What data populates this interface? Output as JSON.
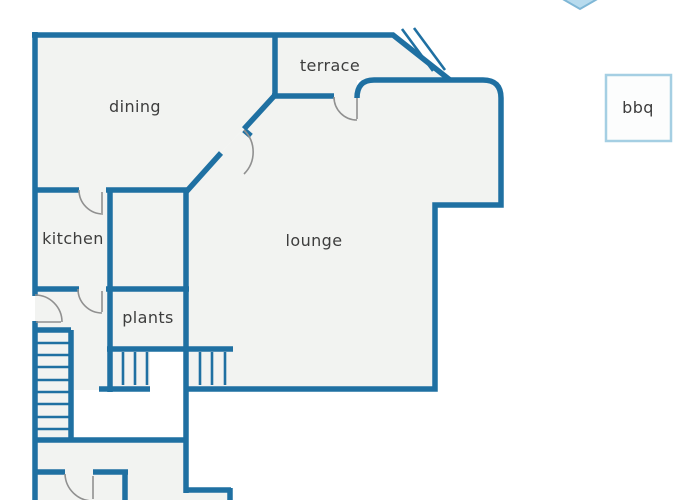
{
  "floorplan": {
    "rooms": [
      {
        "id": "dining",
        "label": "dining"
      },
      {
        "id": "terrace",
        "label": "terrace"
      },
      {
        "id": "kitchen",
        "label": "kitchen"
      },
      {
        "id": "lounge",
        "label": "lounge"
      },
      {
        "id": "plants",
        "label": "plants"
      },
      {
        "id": "bbq",
        "label": "bbq"
      }
    ],
    "features": {
      "staircase_steps": 8,
      "porch_step_flights": 2,
      "terrace_hatch_marks": 2,
      "door_arcs": 6
    },
    "colors": {
      "wall": "#1f70a2",
      "room_fill": "#f2f3f1",
      "door_arc": "#909090",
      "label_text": "#3d3d3d",
      "bbq_border": "#a5cfe3",
      "diamond_fill": "#b7dbee",
      "diamond_border": "#7fb7d6",
      "background": "#ffffff"
    }
  }
}
